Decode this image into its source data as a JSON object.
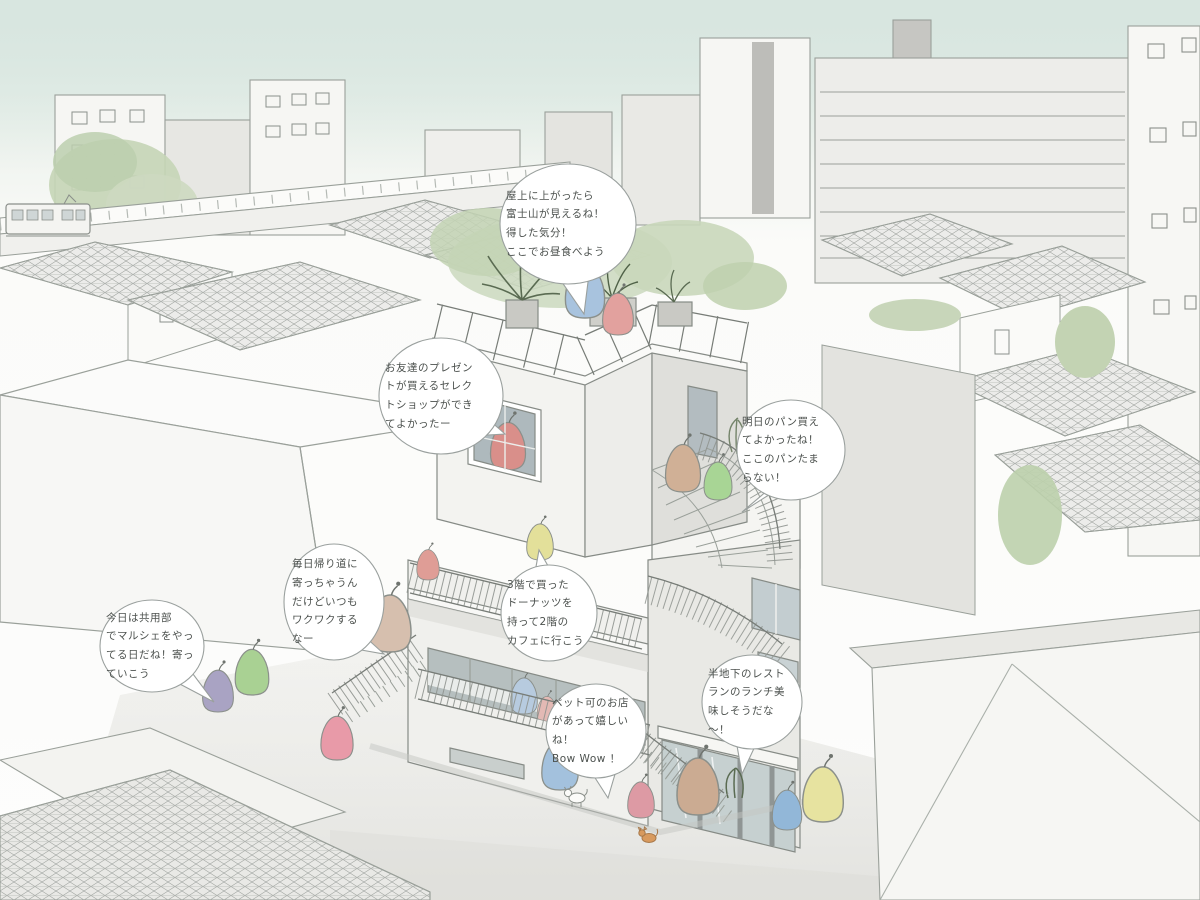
{
  "illustration": {
    "kind": "hand-drawn watercolor concept sketch of a mixed-use building in a Japanese townscape",
    "language": "Japanese"
  },
  "speech_bubbles": [
    {
      "id": "rooftop-lunch",
      "text": "屋上に上がったら\n富士山が見えるね！\n得した気分！\nここでお昼食べよう"
    },
    {
      "id": "select-shop",
      "text": "お友達のプレゼン\nトが買えるセレク\nトショップができ\nてよかったー"
    },
    {
      "id": "bakery",
      "text": "明日のパン買え\nてよかったね！\nここのパンたま\nらない！"
    },
    {
      "id": "daily-stopby",
      "text": "毎日帰り道に\n寄っちゃうん\nだけどいつも\nワクワクする\nなー"
    },
    {
      "id": "marche",
      "text": "今日は共用部\nでマルシェをやっ\nてる日だね！寄っ\nていこう"
    },
    {
      "id": "donuts-to-cafe",
      "text": "3階で買った\nドーナッツを\n持って2階の\nカフェに行こう"
    },
    {
      "id": "pet-friendly",
      "text": "ペット可のお店\nがあって嬉しい\nね！\nBow Wow ！"
    },
    {
      "id": "basement-restaurant",
      "text": "半地下のレスト\nランのランチ美\n味しそうだな\n〜！"
    }
  ],
  "figures": [
    {
      "id": "person-rooftop-blue",
      "color": "#a8c3de"
    },
    {
      "id": "person-rooftop-pink",
      "color": "#e2a19e"
    },
    {
      "id": "person-shop-red",
      "color": "#d98f8a"
    },
    {
      "id": "person-stair-tan",
      "color": "#d0b096"
    },
    {
      "id": "person-stair-green",
      "color": "#a8d595"
    },
    {
      "id": "person-walkway-yellow",
      "color": "#e3e09a"
    },
    {
      "id": "person-terrace-pink",
      "color": "#df9d96"
    },
    {
      "id": "person-cafe-blue",
      "color": "#b7cbdf"
    },
    {
      "id": "person-cafe-pink",
      "color": "#e3b9b4"
    },
    {
      "id": "person-leftstair-tan",
      "color": "#d6bfae"
    },
    {
      "id": "person-street-purple",
      "color": "#a9a3c3"
    },
    {
      "id": "person-street-green",
      "color": "#a9d193"
    },
    {
      "id": "person-street-pink",
      "color": "#e89aa8"
    },
    {
      "id": "person-front-blue",
      "color": "#a3c1dd"
    },
    {
      "id": "person-front-pink",
      "color": "#dd9aa4"
    },
    {
      "id": "person-front-tan",
      "color": "#cbab92"
    },
    {
      "id": "person-right-blue",
      "color": "#92b7d8"
    },
    {
      "id": "person-right-yellow",
      "color": "#e7e3a0"
    }
  ],
  "pets": [
    {
      "id": "dog",
      "color": "#fbfbf9"
    },
    {
      "id": "cat",
      "color": "#d89a5e"
    }
  ],
  "colors": {
    "sky_top": "#d8e6e0",
    "paper": "#fcfcfa",
    "line": "#8b908b",
    "bubble_border": "#9aa09e",
    "bubble_fill": "#ffffff",
    "text": "#4c514e",
    "tile_line": "#a3a7a3",
    "tree_green": "#c6d6b8"
  }
}
